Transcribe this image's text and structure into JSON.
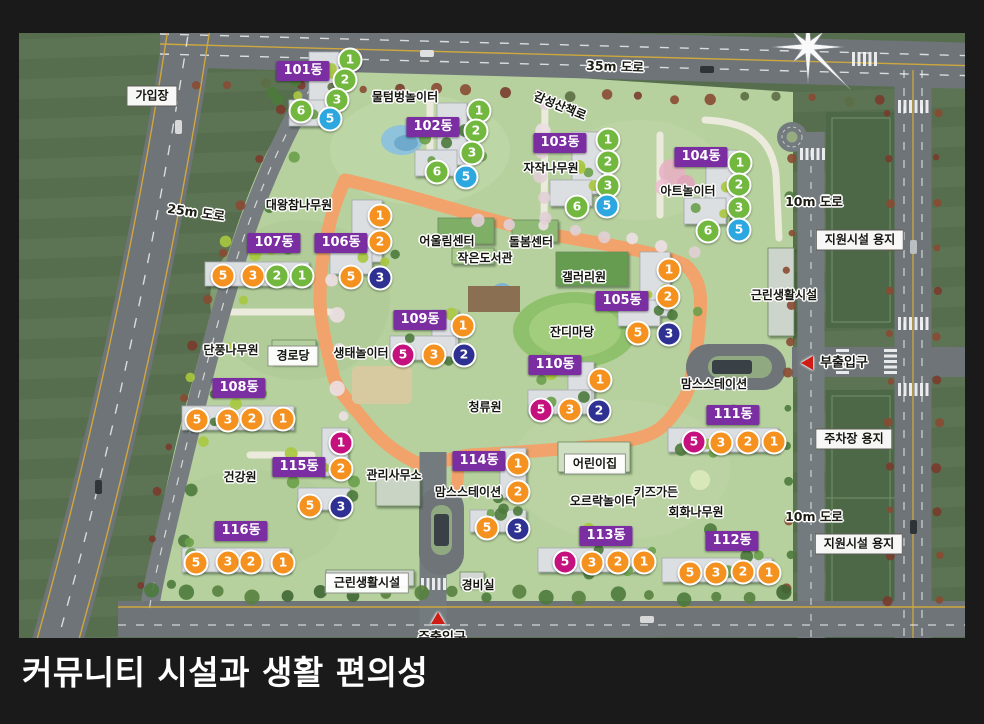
{
  "title": "커뮤니티 시설과 생활 편의성",
  "colors": {
    "frame": "#1a1a1a",
    "building_label_bg": "#7b2da2",
    "marker_green": "#72b73e",
    "marker_cyan": "#2da7e0",
    "marker_orange": "#f5911e",
    "marker_navy": "#2e3192",
    "marker_magenta": "#c4117e",
    "entrance_red": "#cf1d15"
  },
  "building_labels": [
    {
      "label": "101동",
      "x": 303,
      "y": 71
    },
    {
      "label": "102동",
      "x": 433,
      "y": 127
    },
    {
      "label": "103동",
      "x": 560,
      "y": 143
    },
    {
      "label": "104동",
      "x": 701,
      "y": 157
    },
    {
      "label": "105동",
      "x": 622,
      "y": 301
    },
    {
      "label": "106동",
      "x": 341,
      "y": 243
    },
    {
      "label": "107동",
      "x": 274,
      "y": 243
    },
    {
      "label": "108동",
      "x": 239,
      "y": 388
    },
    {
      "label": "109동",
      "x": 420,
      "y": 320
    },
    {
      "label": "110동",
      "x": 555,
      "y": 365
    },
    {
      "label": "111동",
      "x": 733,
      "y": 415
    },
    {
      "label": "112동",
      "x": 732,
      "y": 541
    },
    {
      "label": "113동",
      "x": 606,
      "y": 536
    },
    {
      "label": "114동",
      "x": 479,
      "y": 461
    },
    {
      "label": "115동",
      "x": 299,
      "y": 467
    },
    {
      "label": "116동",
      "x": 241,
      "y": 531
    }
  ],
  "facility_labels": [
    {
      "label": "물텀벙놀이터",
      "x": 405,
      "y": 97
    },
    {
      "label": "감성산책로",
      "x": 560,
      "y": 106,
      "rotate": 22
    },
    {
      "label": "자작나무원",
      "x": 551,
      "y": 168
    },
    {
      "label": "아트놀이터",
      "x": 688,
      "y": 191
    },
    {
      "label": "대왕참나무원",
      "x": 299,
      "y": 205
    },
    {
      "label": "어울림센터",
      "x": 447,
      "y": 241
    },
    {
      "label": "돌봄센터",
      "x": 531,
      "y": 242
    },
    {
      "label": "작은도서관",
      "x": 485,
      "y": 258
    },
    {
      "label": "갤러리원",
      "x": 584,
      "y": 277
    },
    {
      "label": "잔디마당",
      "x": 572,
      "y": 332
    },
    {
      "label": "단풍나무원",
      "x": 231,
      "y": 350
    },
    {
      "label": "생태놀이터",
      "x": 361,
      "y": 353
    },
    {
      "label": "청류원",
      "x": 485,
      "y": 407
    },
    {
      "label": "근린생활시설",
      "x": 784,
      "y": 295
    },
    {
      "label": "맘스스테이션",
      "x": 714,
      "y": 384
    },
    {
      "label": "회화나무원",
      "x": 696,
      "y": 512
    },
    {
      "label": "건강원",
      "x": 240,
      "y": 477
    },
    {
      "label": "관리사무소",
      "x": 394,
      "y": 475
    },
    {
      "label": "맘스스테이션",
      "x": 468,
      "y": 492
    },
    {
      "label": "오르락놀이터",
      "x": 603,
      "y": 501
    },
    {
      "label": "키즈가든",
      "x": 656,
      "y": 492
    },
    {
      "label": "경비실",
      "x": 478,
      "y": 585
    }
  ],
  "road_labels": [
    {
      "label": "35m 도로",
      "x": 615,
      "y": 67,
      "rotate": 2
    },
    {
      "label": "25m 도로",
      "x": 196,
      "y": 213,
      "rotate": 8
    },
    {
      "label": "10m 도로",
      "x": 814,
      "y": 202,
      "rotate": 0
    },
    {
      "label": "10m 도로",
      "x": 814,
      "y": 517,
      "rotate": 0
    }
  ],
  "zone_labels": [
    {
      "label": "가입장",
      "x": 152,
      "y": 96
    },
    {
      "label": "지원시설 용지",
      "x": 860,
      "y": 240
    },
    {
      "label": "주차장 용지",
      "x": 854,
      "y": 439
    },
    {
      "label": "지원시설 용지",
      "x": 859,
      "y": 544
    },
    {
      "label": "경로당",
      "x": 293,
      "y": 356,
      "plain": true
    },
    {
      "label": "어린이집",
      "x": 595,
      "y": 464,
      "plain": true
    },
    {
      "label": "근린생활시설",
      "x": 367,
      "y": 583,
      "plain": true
    }
  ],
  "entrances": [
    {
      "label": "부출입구",
      "text_x": 844,
      "text_y": 363,
      "arrow": "left",
      "arrow_x": 807,
      "arrow_y": 363
    },
    {
      "label": "주출입구",
      "text_x": 442,
      "text_y": 638,
      "arrow": "up",
      "arrow_x": 438,
      "arrow_y": 618
    }
  ],
  "markers": [
    {
      "n": "1",
      "color": "green",
      "x": 350,
      "y": 60
    },
    {
      "n": "2",
      "color": "green",
      "x": 345,
      "y": 80
    },
    {
      "n": "3",
      "color": "green",
      "x": 337,
      "y": 100
    },
    {
      "n": "6",
      "color": "green",
      "x": 301,
      "y": 111
    },
    {
      "n": "5",
      "color": "cyan",
      "x": 330,
      "y": 119
    },
    {
      "n": "1",
      "color": "green",
      "x": 479,
      "y": 111
    },
    {
      "n": "2",
      "color": "green",
      "x": 476,
      "y": 131
    },
    {
      "n": "3",
      "color": "green",
      "x": 472,
      "y": 153
    },
    {
      "n": "6",
      "color": "green",
      "x": 437,
      "y": 172
    },
    {
      "n": "5",
      "color": "cyan",
      "x": 466,
      "y": 177
    },
    {
      "n": "1",
      "color": "green",
      "x": 608,
      "y": 140
    },
    {
      "n": "2",
      "color": "green",
      "x": 608,
      "y": 162
    },
    {
      "n": "3",
      "color": "green",
      "x": 608,
      "y": 186
    },
    {
      "n": "6",
      "color": "green",
      "x": 577,
      "y": 207
    },
    {
      "n": "5",
      "color": "cyan",
      "x": 607,
      "y": 206
    },
    {
      "n": "1",
      "color": "green",
      "x": 740,
      "y": 163
    },
    {
      "n": "2",
      "color": "green",
      "x": 739,
      "y": 185
    },
    {
      "n": "3",
      "color": "green",
      "x": 739,
      "y": 208
    },
    {
      "n": "6",
      "color": "green",
      "x": 708,
      "y": 231
    },
    {
      "n": "5",
      "color": "cyan",
      "x": 739,
      "y": 230
    },
    {
      "n": "1",
      "color": "orange",
      "x": 380,
      "y": 216
    },
    {
      "n": "2",
      "color": "orange",
      "x": 380,
      "y": 242
    },
    {
      "n": "5",
      "color": "orange",
      "x": 351,
      "y": 277
    },
    {
      "n": "3",
      "color": "navy",
      "x": 380,
      "y": 278
    },
    {
      "n": "5",
      "color": "orange",
      "x": 223,
      "y": 276
    },
    {
      "n": "3",
      "color": "orange",
      "x": 253,
      "y": 276
    },
    {
      "n": "2",
      "color": "green",
      "x": 277,
      "y": 276
    },
    {
      "n": "1",
      "color": "green",
      "x": 302,
      "y": 276
    },
    {
      "n": "1",
      "color": "orange",
      "x": 669,
      "y": 270
    },
    {
      "n": "2",
      "color": "orange",
      "x": 668,
      "y": 297
    },
    {
      "n": "5",
      "color": "orange",
      "x": 638,
      "y": 333
    },
    {
      "n": "3",
      "color": "navy",
      "x": 669,
      "y": 334
    },
    {
      "n": "1",
      "color": "orange",
      "x": 463,
      "y": 326
    },
    {
      "n": "5",
      "color": "magenta",
      "x": 403,
      "y": 355
    },
    {
      "n": "3",
      "color": "orange",
      "x": 434,
      "y": 355
    },
    {
      "n": "2",
      "color": "navy",
      "x": 464,
      "y": 355
    },
    {
      "n": "1",
      "color": "orange",
      "x": 600,
      "y": 380
    },
    {
      "n": "5",
      "color": "magenta",
      "x": 541,
      "y": 410
    },
    {
      "n": "3",
      "color": "orange",
      "x": 570,
      "y": 410
    },
    {
      "n": "2",
      "color": "navy",
      "x": 599,
      "y": 411
    },
    {
      "n": "5",
      "color": "orange",
      "x": 197,
      "y": 420
    },
    {
      "n": "3",
      "color": "orange",
      "x": 228,
      "y": 420
    },
    {
      "n": "2",
      "color": "orange",
      "x": 252,
      "y": 419
    },
    {
      "n": "1",
      "color": "orange",
      "x": 283,
      "y": 419
    },
    {
      "n": "5",
      "color": "magenta",
      "x": 694,
      "y": 442
    },
    {
      "n": "3",
      "color": "orange",
      "x": 721,
      "y": 443
    },
    {
      "n": "2",
      "color": "orange",
      "x": 748,
      "y": 442
    },
    {
      "n": "1",
      "color": "orange",
      "x": 774,
      "y": 442
    },
    {
      "n": "1",
      "color": "magenta",
      "x": 341,
      "y": 443
    },
    {
      "n": "2",
      "color": "orange",
      "x": 341,
      "y": 469
    },
    {
      "n": "5",
      "color": "orange",
      "x": 310,
      "y": 506
    },
    {
      "n": "3",
      "color": "navy",
      "x": 341,
      "y": 507
    },
    {
      "n": "1",
      "color": "orange",
      "x": 518,
      "y": 464
    },
    {
      "n": "2",
      "color": "orange",
      "x": 518,
      "y": 492
    },
    {
      "n": "5",
      "color": "orange",
      "x": 487,
      "y": 528
    },
    {
      "n": "3",
      "color": "navy",
      "x": 518,
      "y": 529
    },
    {
      "n": "5",
      "color": "orange",
      "x": 196,
      "y": 563
    },
    {
      "n": "3",
      "color": "orange",
      "x": 228,
      "y": 562
    },
    {
      "n": "2",
      "color": "orange",
      "x": 251,
      "y": 562
    },
    {
      "n": "1",
      "color": "orange",
      "x": 283,
      "y": 563
    },
    {
      "n": "5",
      "color": "magenta",
      "x": 565,
      "y": 562
    },
    {
      "n": "3",
      "color": "orange",
      "x": 592,
      "y": 563
    },
    {
      "n": "2",
      "color": "orange",
      "x": 618,
      "y": 562
    },
    {
      "n": "1",
      "color": "orange",
      "x": 644,
      "y": 562
    },
    {
      "n": "5",
      "color": "orange",
      "x": 690,
      "y": 573
    },
    {
      "n": "3",
      "color": "orange",
      "x": 716,
      "y": 573
    },
    {
      "n": "2",
      "color": "orange",
      "x": 743,
      "y": 572
    },
    {
      "n": "1",
      "color": "orange",
      "x": 769,
      "y": 573
    }
  ]
}
